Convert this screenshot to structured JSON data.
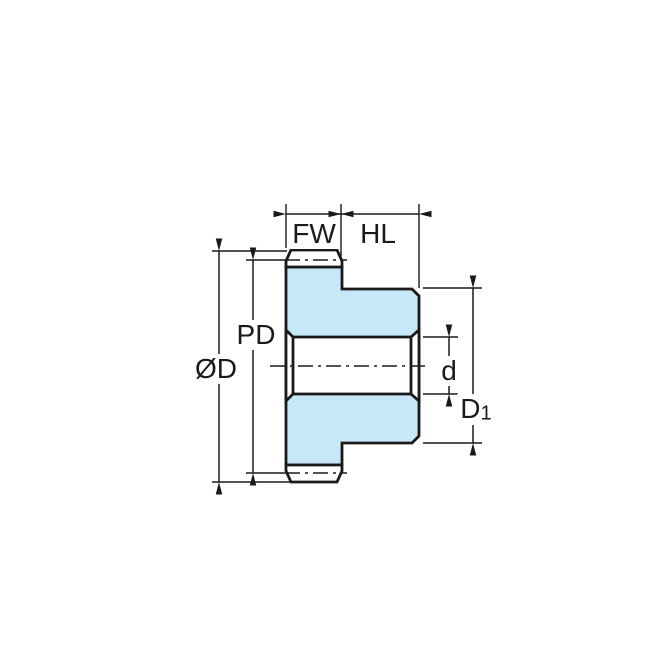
{
  "diagram": {
    "type": "spur-gear-cross-section-dimension-drawing"
  },
  "labels": {
    "face_width": "FW",
    "hub_length": "HL",
    "pitch_diameter": "PD",
    "outside_diameter": "ØD",
    "bore_diameter": "d",
    "hub_diameter_main": "D",
    "hub_diameter_sub": "1"
  },
  "colors": {
    "part_fill": "#C7E8F8",
    "line": "#1A1A1A",
    "background": "#FFFFFF"
  }
}
